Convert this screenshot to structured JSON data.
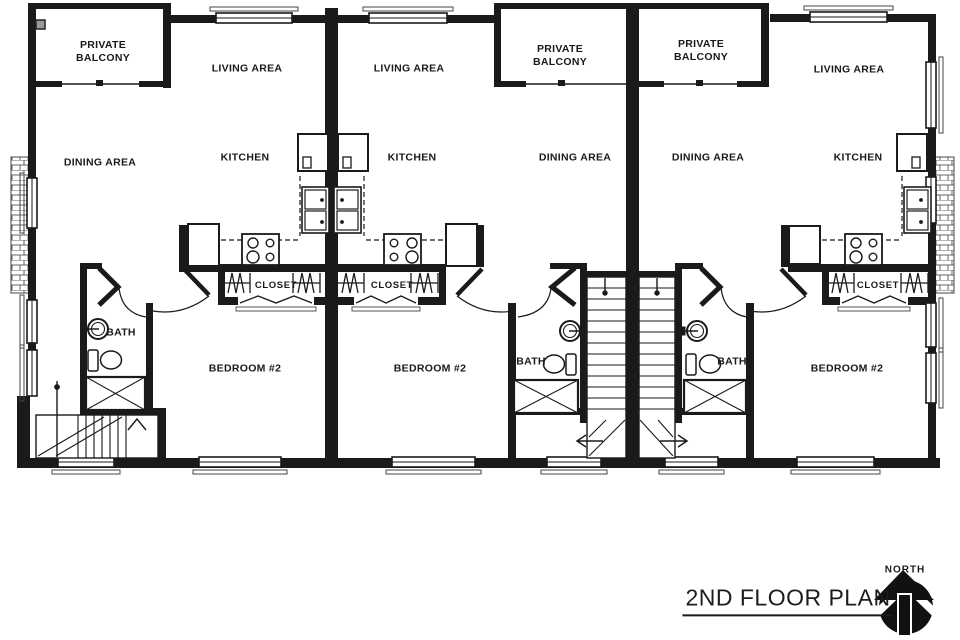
{
  "document": {
    "title": "2ND FLOOR PLAN",
    "north_label": "NORTH"
  },
  "colors": {
    "ink": "#1a1a1a",
    "paper": "#ffffff"
  },
  "units": [
    {
      "name": "left unit",
      "balcony": "PRIVATE BALCONY",
      "living": "LIVING AREA",
      "dining": "DINING AREA",
      "kitchen": "KITCHEN",
      "closet": "CLOSET",
      "bath": "BATH",
      "bedroom": "BEDROOM #2"
    },
    {
      "name": "middle unit",
      "balcony": "PRIVATE BALCONY",
      "living": "LIVING AREA",
      "dining": "DINING AREA",
      "kitchen": "KITCHEN",
      "closet": "CLOSET",
      "bath": "BATH",
      "bedroom": "BEDROOM #2"
    },
    {
      "name": "right unit",
      "balcony": "PRIVATE BALCONY",
      "living": "LIVING AREA",
      "dining": "DINING AREA",
      "kitchen": "KITCHEN",
      "closet": "CLOSET",
      "bath": "BATH",
      "bedroom": "BEDROOM #2"
    }
  ]
}
